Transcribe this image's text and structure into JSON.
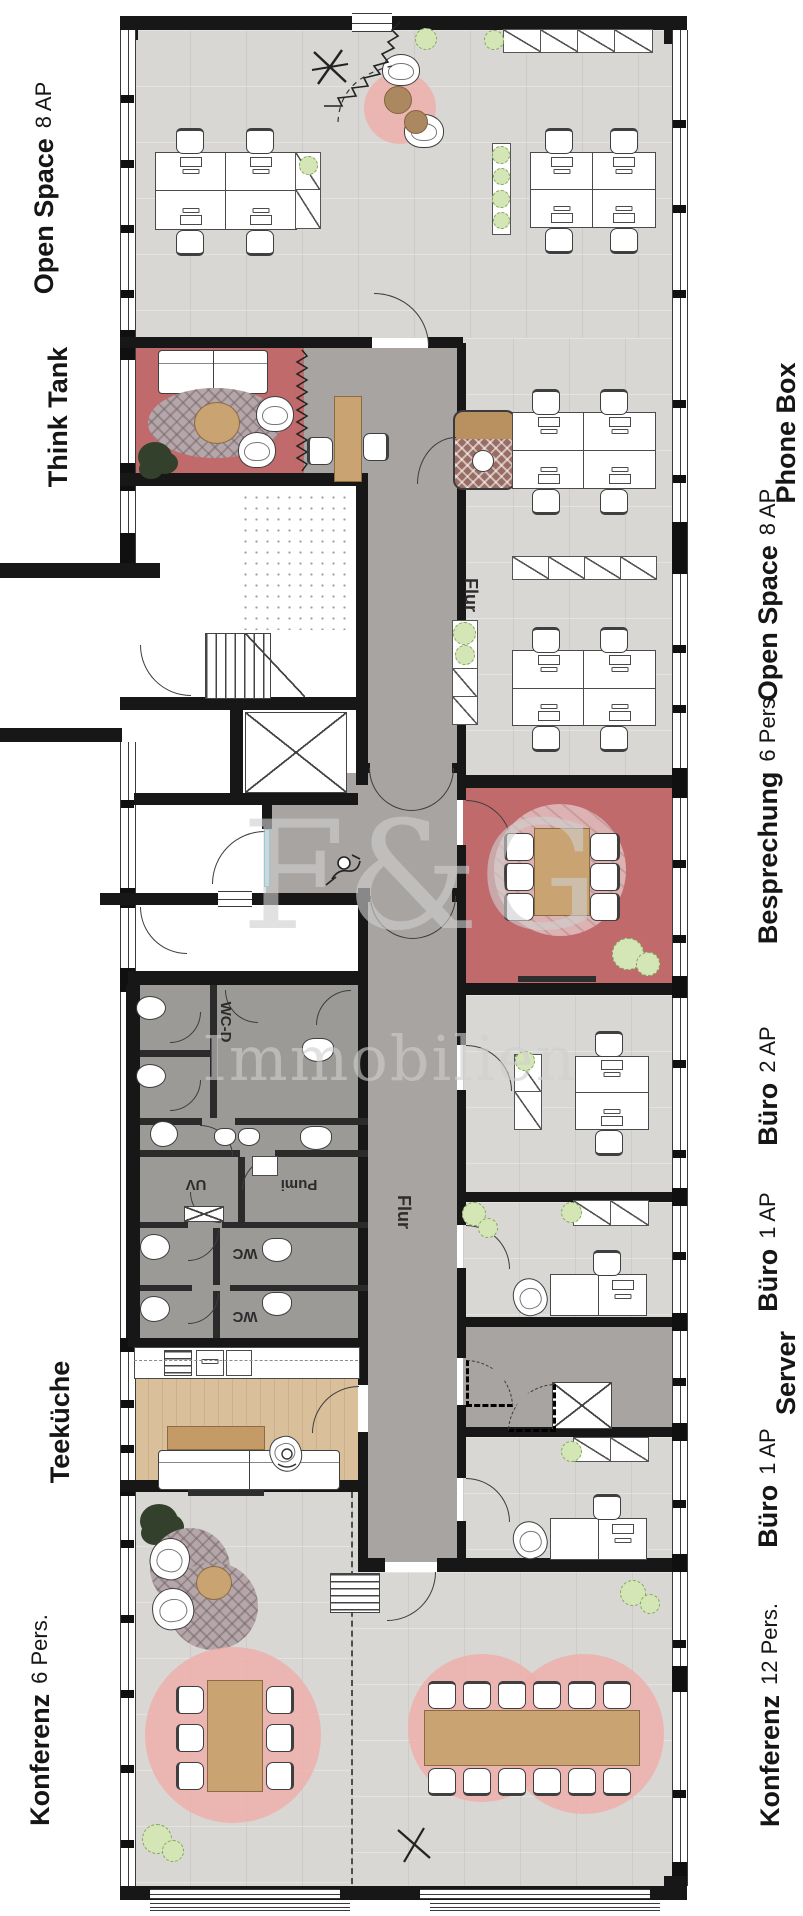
{
  "watermark": {
    "line1": "F&G",
    "line2": "Immobilien"
  },
  "rooms": {
    "left": [
      {
        "name": "Open Space",
        "capacity": "8 AP"
      },
      {
        "name": "Think Tank",
        "capacity": ""
      },
      {
        "name": "Teeküche",
        "capacity": ""
      },
      {
        "name": "Konferenz",
        "capacity": "6 Pers."
      }
    ],
    "right": [
      {
        "name": "Phone Box",
        "capacity": ""
      },
      {
        "name": "Open Space",
        "capacity": "8 AP"
      },
      {
        "name": "Besprechung",
        "capacity": "6 Pers."
      },
      {
        "name": "Büro",
        "capacity": "2 AP"
      },
      {
        "name": "Büro",
        "capacity": "1 AP"
      },
      {
        "name": "Server",
        "capacity": ""
      },
      {
        "name": "Büro",
        "capacity": "1 AP"
      },
      {
        "name": "Konferenz",
        "capacity": "12 Pers."
      }
    ],
    "interior": {
      "flur1": "Flur",
      "flur2": "Flur",
      "wcd": "WC-D",
      "uv": "UV",
      "pumi": "Pumi",
      "wc1": "WC",
      "wc2": "WC"
    }
  },
  "colors": {
    "floor_light": "#d8d7d4",
    "floor_dark": "#a7a4a1",
    "floor_red": "#c06a6c",
    "floor_wood": "#d9c09b",
    "accent_pink": "#eeafac",
    "wall": "#171717",
    "door_blue": "#bfe8f2",
    "plant_green": "#d4e6b6"
  }
}
